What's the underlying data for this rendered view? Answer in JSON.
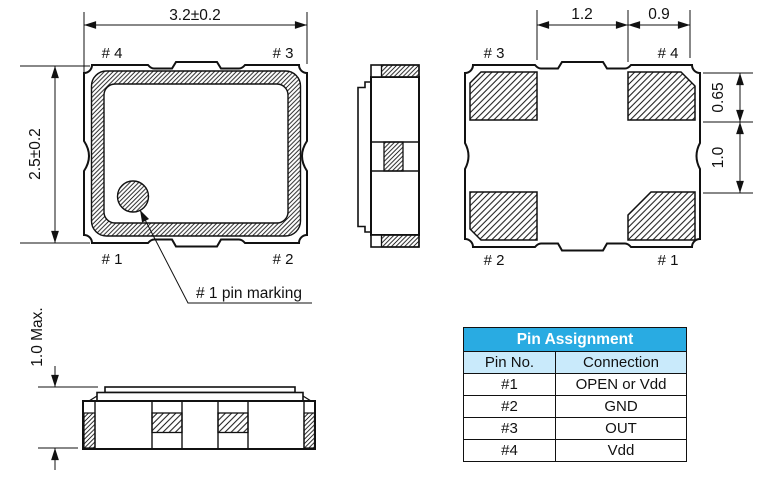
{
  "drawing": {
    "top_view": {
      "dim_width": "3.2±0.2",
      "dim_height": "2.5±0.2",
      "pin_top_left": "# 4",
      "pin_top_right": "# 3",
      "pin_bottom_left": "# 1",
      "pin_bottom_right": "# 2",
      "marking_label": "# 1 pin marking"
    },
    "side_view": {
      "dim_height": "1.0 Max."
    },
    "bottom_view": {
      "dim_center_gap": "1.2",
      "dim_pad_width": "0.9",
      "dim_pad_height": "0.65",
      "dim_pad_gap": "1.0",
      "pin_top_left": "# 3",
      "pin_top_right": "# 4",
      "pin_bottom_left": "# 2",
      "pin_bottom_right": "# 1"
    }
  },
  "pin_table": {
    "title": "Pin Assignment",
    "columns": {
      "pin": "Pin No.",
      "connection": "Connection"
    },
    "rows": [
      {
        "pin": "#1",
        "connection": "OPEN or Vdd"
      },
      {
        "pin": "#2",
        "connection": "GND"
      },
      {
        "pin": "#3",
        "connection": "OUT"
      },
      {
        "pin": "#4",
        "connection": "Vdd"
      }
    ]
  },
  "colors": {
    "table_header_bg": "#29abe2",
    "table_subheader_bg": "#c9eafb",
    "line_color": "#111111"
  }
}
